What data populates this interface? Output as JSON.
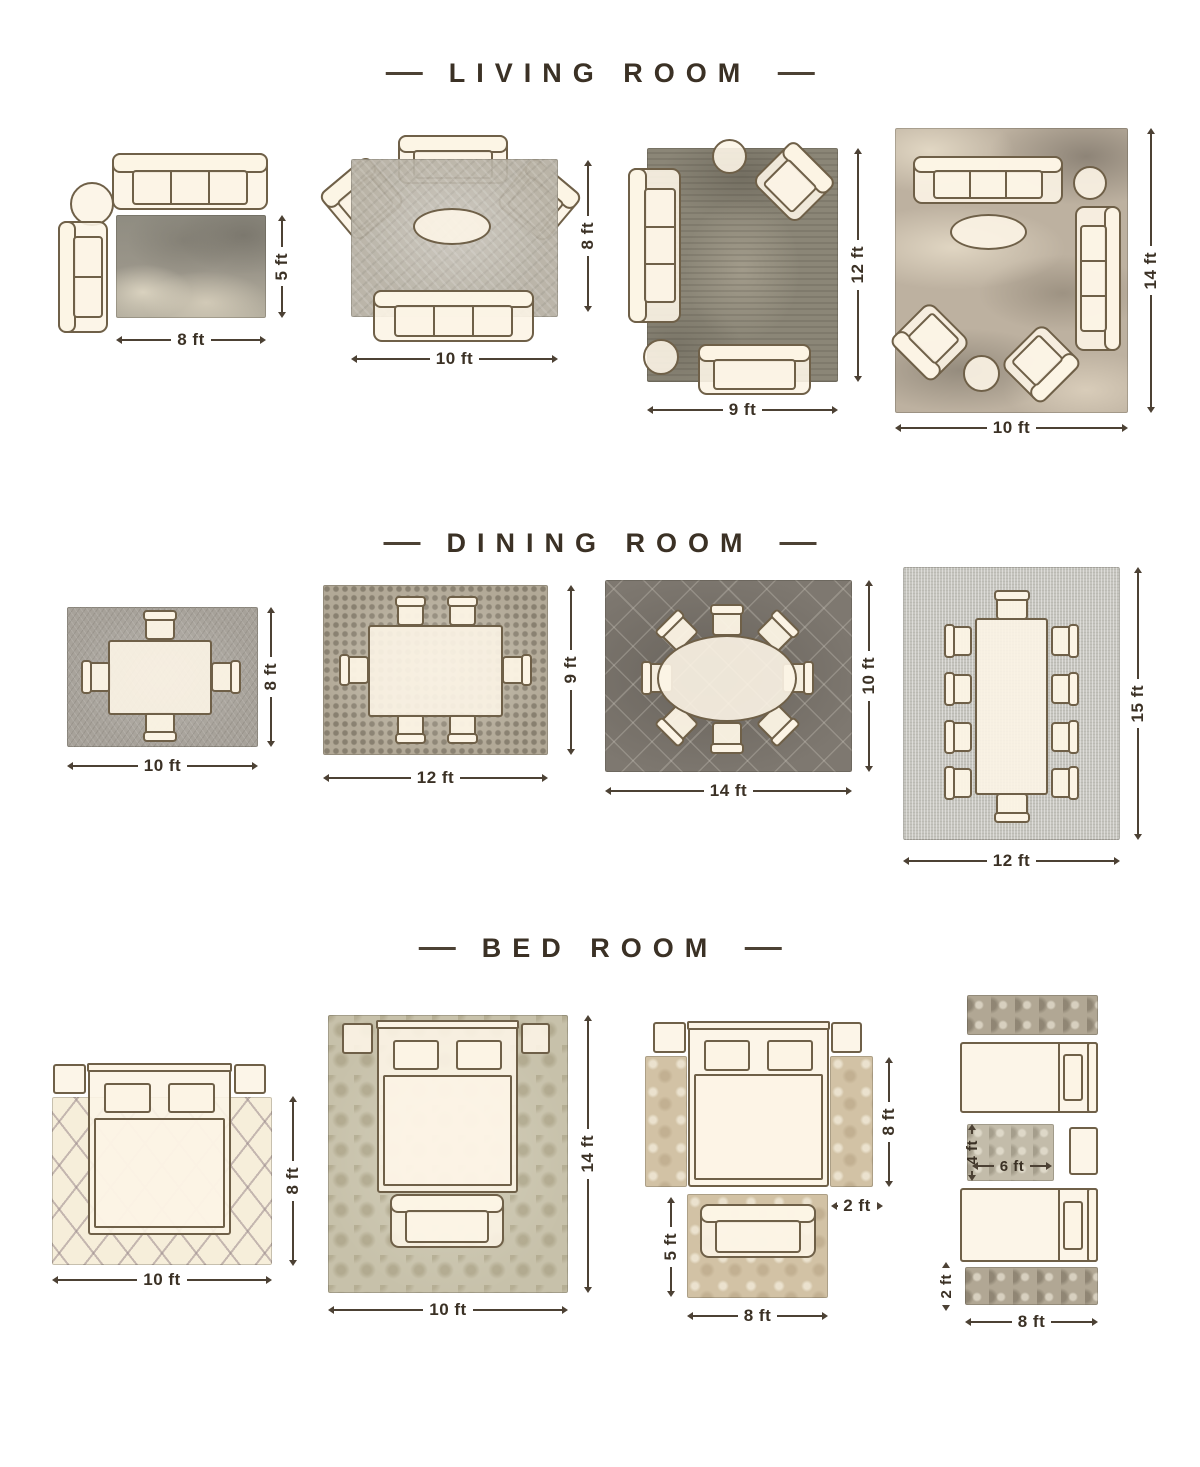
{
  "palette": {
    "background": "#ffffff",
    "text": "#3b3125",
    "line": "#4c4134",
    "furniture_outline": "#6f6048",
    "furniture_fill": "#fcf4e5"
  },
  "sections": {
    "living": {
      "title": "LIVING ROOM",
      "layouts": [
        {
          "width": "8 ft",
          "height": "5 ft"
        },
        {
          "width": "10 ft",
          "height": "8 ft"
        },
        {
          "width": "9 ft",
          "height": "12 ft"
        },
        {
          "width": "10 ft",
          "height": "14 ft"
        }
      ]
    },
    "dining": {
      "title": "DINING ROOM",
      "layouts": [
        {
          "width": "10 ft",
          "height": "8 ft"
        },
        {
          "width": "12 ft",
          "height": "9 ft"
        },
        {
          "width": "14 ft",
          "height": "10 ft"
        },
        {
          "width": "12 ft",
          "height": "15 ft"
        }
      ]
    },
    "bed": {
      "title": "BED ROOM",
      "layouts": [
        {
          "width": "10 ft",
          "height": "8 ft"
        },
        {
          "width": "10 ft",
          "height": "14 ft"
        },
        {
          "side_runner_length": "8 ft",
          "side_runner_width": "2 ft",
          "front_rug_height": "5 ft",
          "front_rug_width": "8 ft"
        },
        {
          "small_rug_height": "4 ft",
          "small_rug_width": "6 ft",
          "runner_height": "2 ft",
          "runner_width": "8 ft"
        }
      ]
    }
  }
}
